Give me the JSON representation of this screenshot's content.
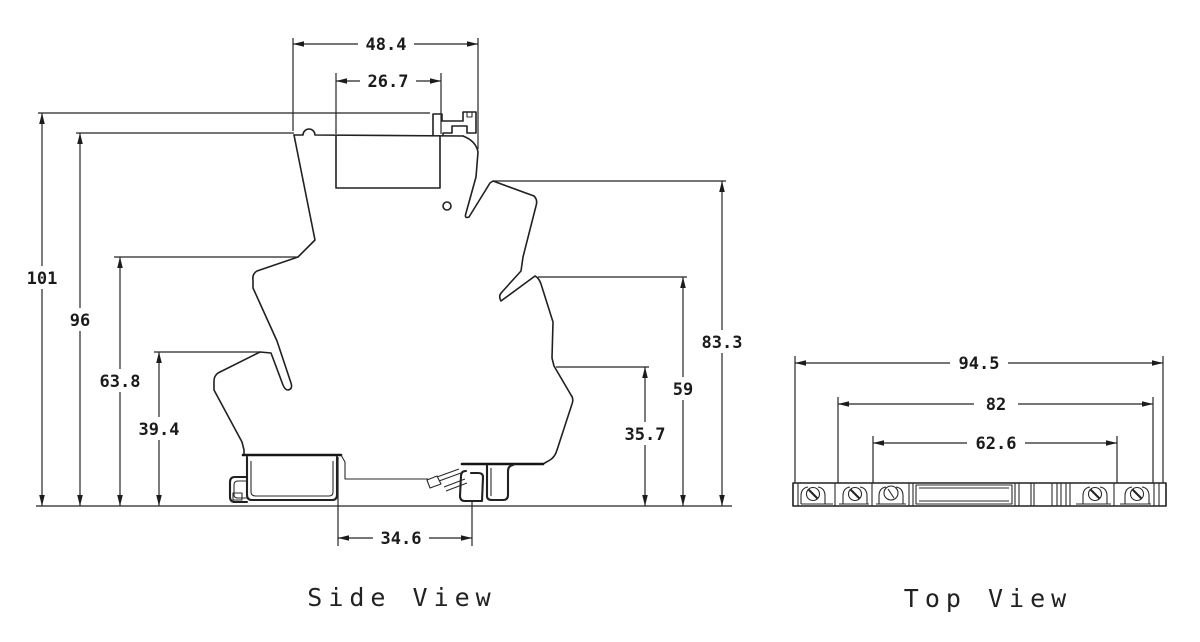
{
  "drawing": {
    "side_view": {
      "title": "Side View",
      "dims": {
        "top_width": "48.4",
        "top_inner_width": "26.7",
        "overall_height": "101",
        "upper_height": "96",
        "mid_height": "63.8",
        "lower_height": "39.4",
        "right_height": "83.3",
        "right_mid_height": "59",
        "right_lower_height": "35.7",
        "bottom_width": "34.6"
      }
    },
    "top_view": {
      "title": "Top View",
      "dims": {
        "overall_width": "94.5",
        "mid_width": "82",
        "inner_width": "62.6"
      }
    }
  }
}
